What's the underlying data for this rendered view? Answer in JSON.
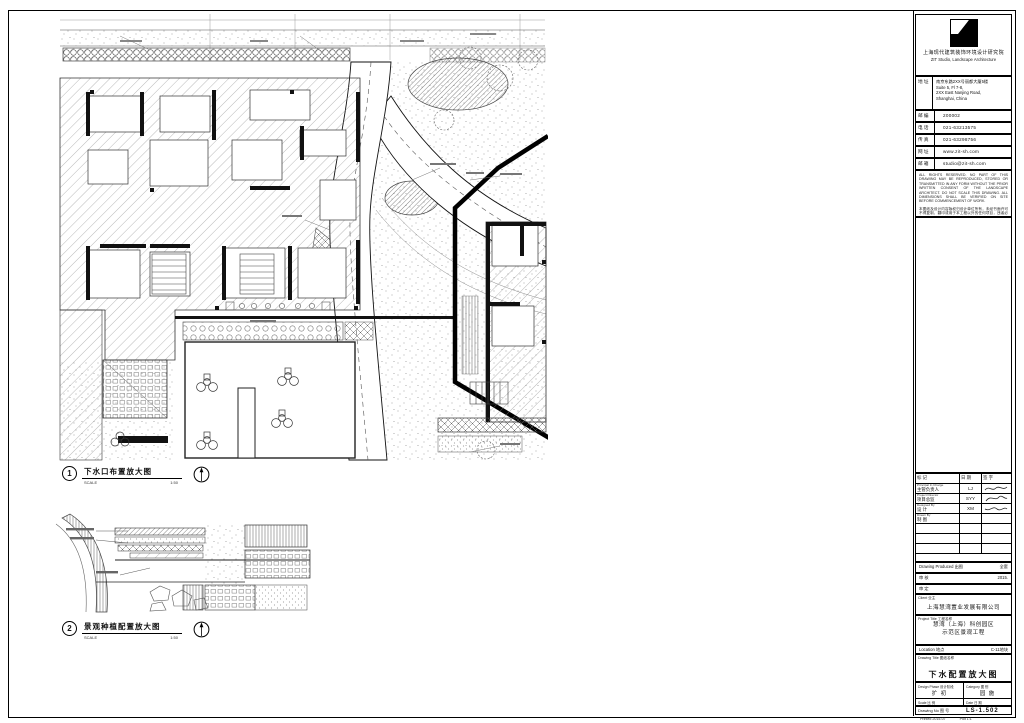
{
  "sheet": {
    "details": [
      {
        "num": "1",
        "title": "下水口布置放大图",
        "scale_word": "SCALE",
        "scale": "1:50"
      },
      {
        "num": "2",
        "title": "景观种植配置放大图",
        "scale_word": "SCALE",
        "scale": "1:50"
      }
    ],
    "titleblock": {
      "firm_cn": "上海现代建筑装饰环境设计研究院",
      "firm_en": "ZIT Studio, Landscape Architecture",
      "addr_label": "地 址",
      "addr_lines": [
        "南京东路2XX号丽都大厦5楼",
        "Suite 5, Fl 7-8,",
        "2XX East Nanjing Road,",
        "Shanghai, China"
      ],
      "info_rows": [
        {
          "label": "邮 编",
          "value": "200002"
        },
        {
          "label": "电 话",
          "value": "021-63213575"
        },
        {
          "label": "传 真",
          "value": "021-63298756"
        },
        {
          "label": "网 址",
          "value": "www.zit-sh.com"
        },
        {
          "label": "邮 箱",
          "value": "studio@zit-sh.com"
        }
      ],
      "notes_en": "ALL RIGHTS RESERVED. NO PART OF THIS DRAWING MAY BE REPRODUCED, STORED OR TRANSMITTED IN ANY FORM WITHOUT THE PRIOR WRITTEN CONSENT OF THE LANDSCAPE ARCHITECT. DO NOT SCALE THIS DRAWING. ALL DIMENSIONS SHALL BE VERIFIED ON SITE BEFORE COMMENCEMENT OF WORK.",
      "notes_cn": "本图纸及设计内容版权归设计单位所有，未经书面许可不得复制、翻印或用于本工程以外的任何项目，违者必究。施工前须复核现场尺寸，如有出入应及时通知设计单位协商解决，图中尺寸以标注为准，不得直接量取图纸。",
      "sig_header": [
        "标 记",
        "日 期",
        "签 字"
      ],
      "sig_rows": [
        {
          "role_en": "Principal In Charge",
          "role_cn": "主管负责人",
          "name": "LJ"
        },
        {
          "role_en": "Project Director",
          "role_cn": "项目总监",
          "name": "SYY"
        },
        {
          "role_en": "Designed By",
          "role_cn": "设 计",
          "name": "XM"
        },
        {
          "role_en": "Drawn By",
          "role_cn": "制 图",
          "name": ""
        },
        {
          "role_en": "",
          "role_cn": "",
          "name": ""
        },
        {
          "role_en": "",
          "role_cn": "",
          "name": ""
        },
        {
          "role_en": "",
          "role_cn": "",
          "name": ""
        }
      ],
      "produced": {
        "label": "Drawing Produced 出图",
        "value": "全套"
      },
      "check_rows": [
        {
          "label": "审 核",
          "value": "2015."
        },
        {
          "label": "审 定",
          "value": ""
        }
      ],
      "client": {
        "label": "Client 业主",
        "value": "上海慧湾置业发展有限公司"
      },
      "project": {
        "label": "Project Title 工程名称",
        "lines": [
          "慧湾（上海）科创园区",
          "示范区景观工程"
        ]
      },
      "location": {
        "label": "Location 地点",
        "value": "C-11地块"
      },
      "title": {
        "label": "Drawing Title 图纸名称",
        "value": "下水配置放大图"
      },
      "bottom": {
        "phase": {
          "label": "Design Phase 设计阶段",
          "value": "扩 初"
        },
        "category": {
          "label": "Category 图 别",
          "value": "园 施"
        },
        "scale": {
          "label": "Scale 比 例",
          "value": "1:150"
        },
        "date": {
          "label": "Date 日 期",
          "value": "2015.07"
        },
        "number": {
          "label": "Drawing No 图 号",
          "value": "LS-1.502"
        }
      },
      "footer": {
        "left": "Printed 2015-07",
        "right": "Plot 1:1"
      }
    }
  }
}
